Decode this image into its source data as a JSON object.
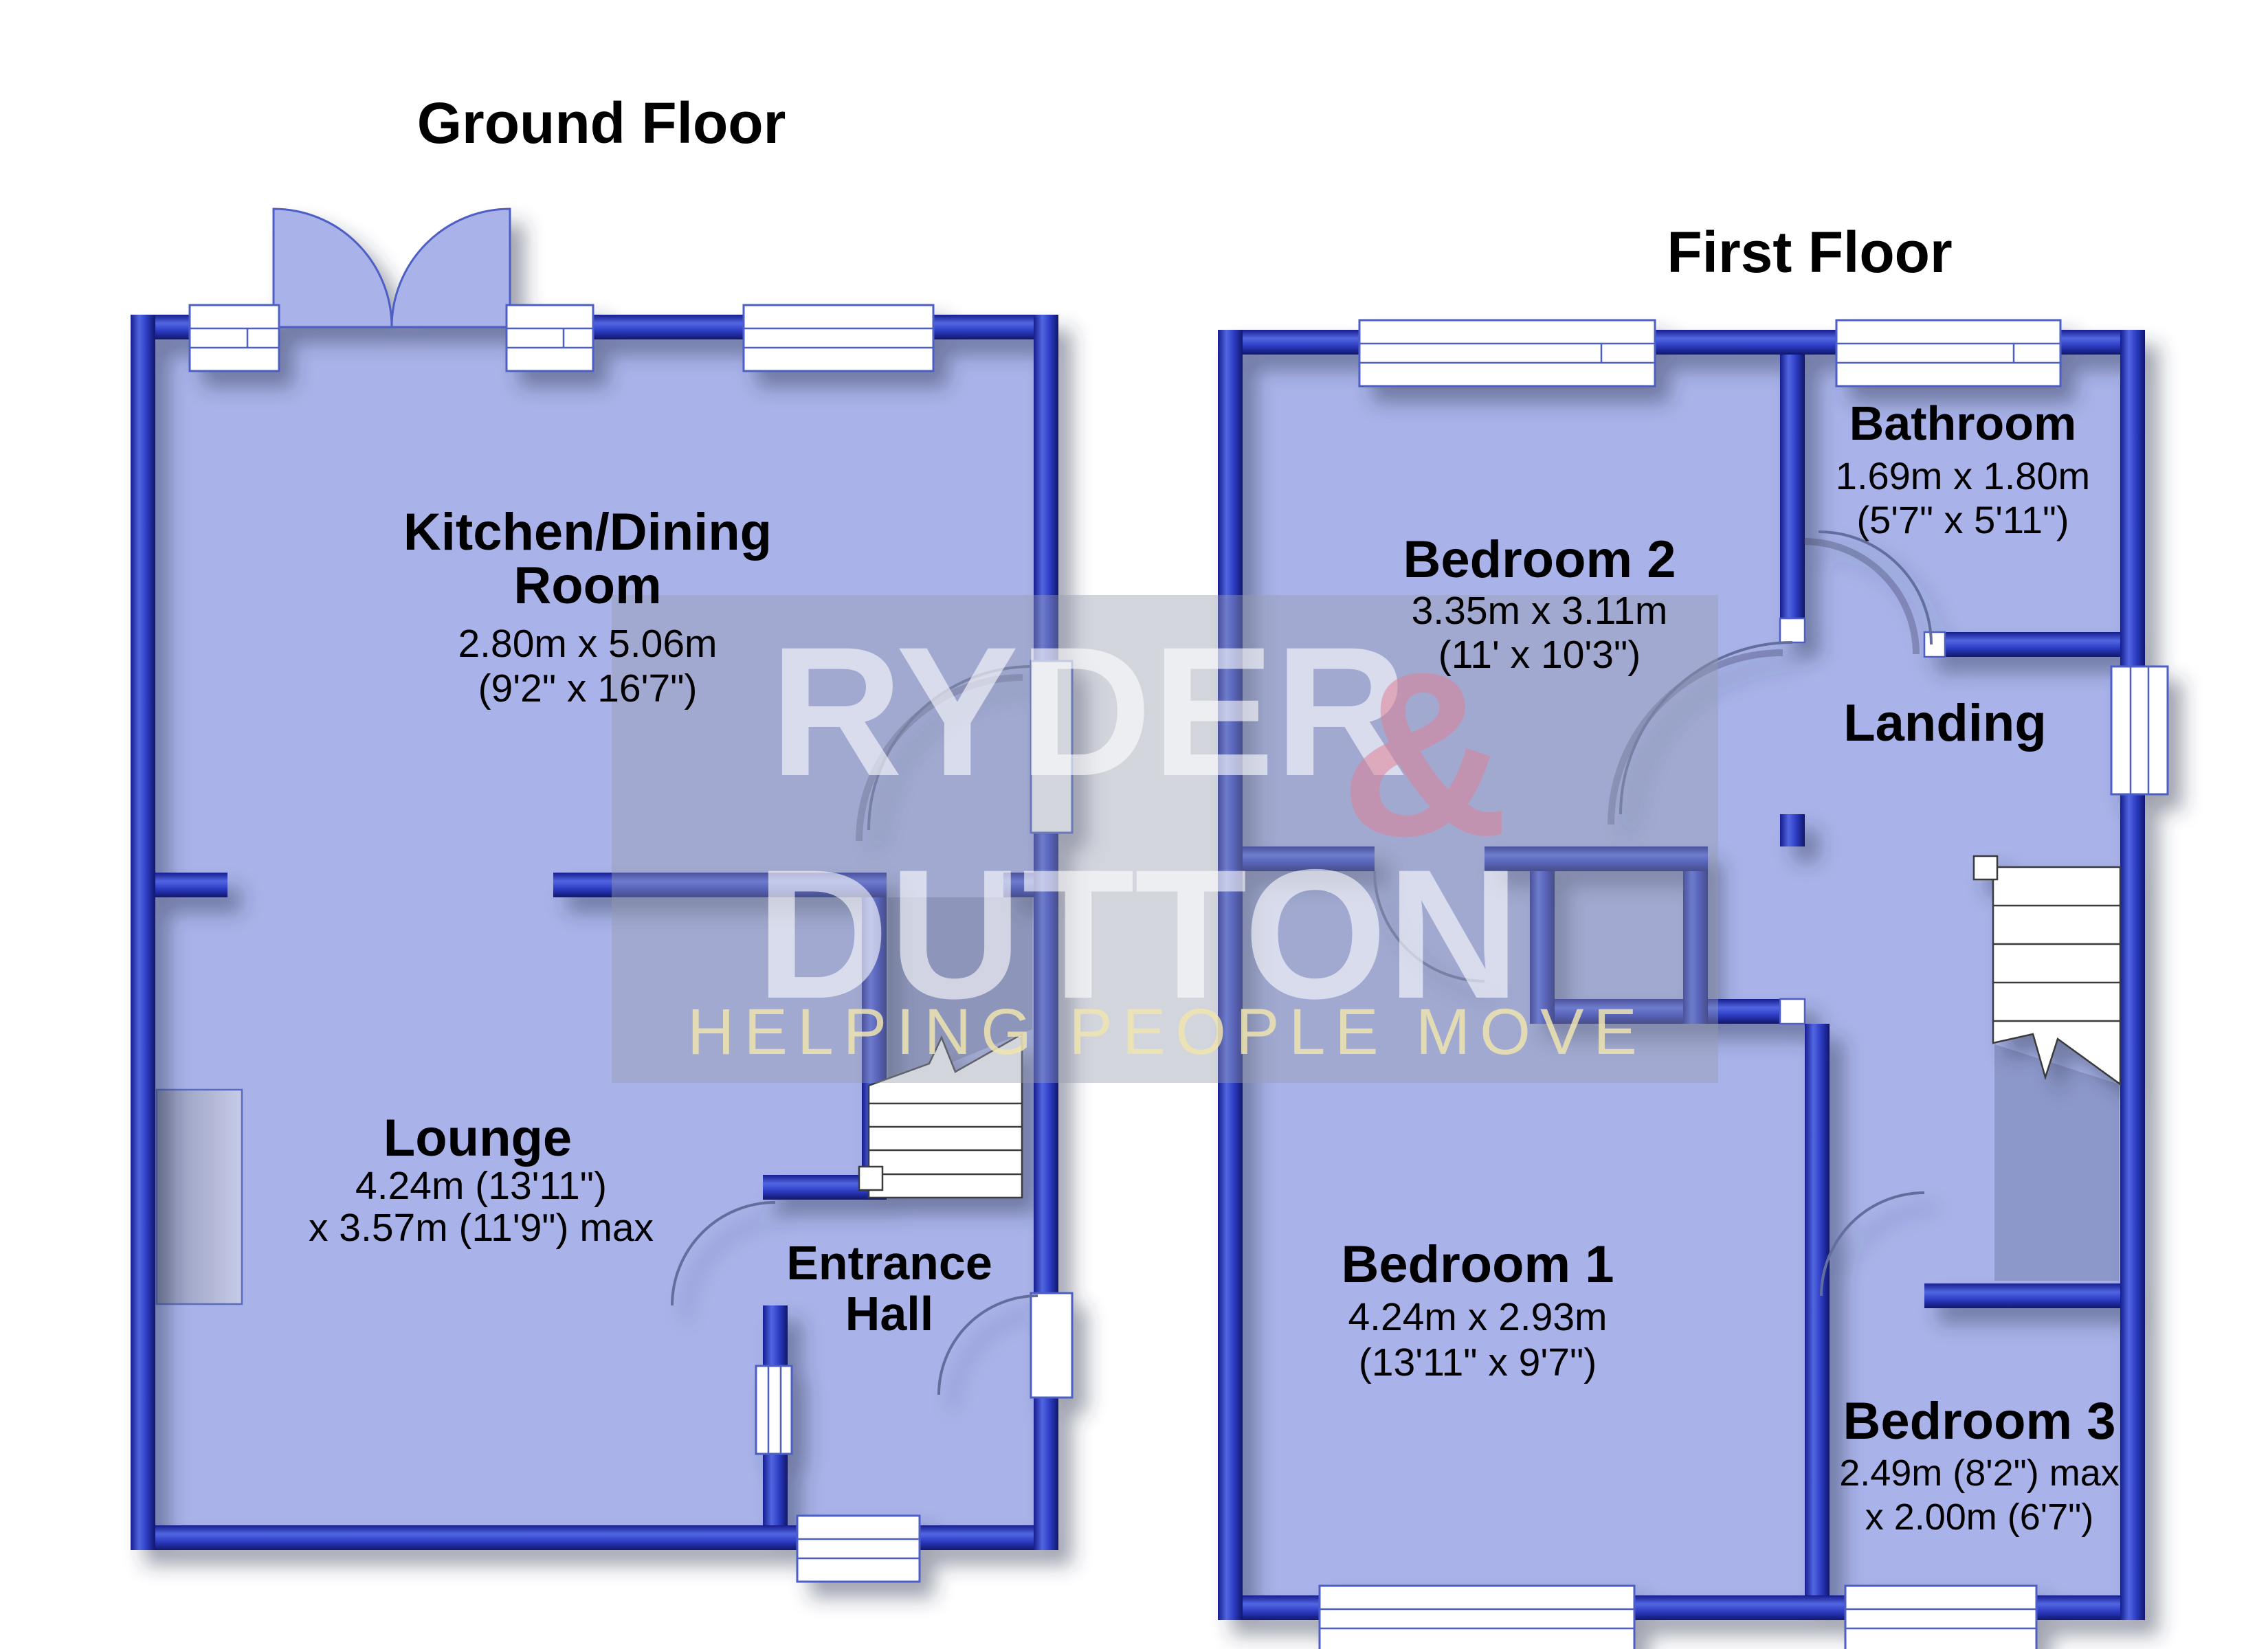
{
  "document": {
    "type": "floorplan",
    "background": "#ffffff"
  },
  "colors": {
    "wall_blue": "#3142c8",
    "wall_dark": "#141c86",
    "floor_fill": "#a9b3e9",
    "window_outline": "#4e5ec4",
    "label_text": "#000000",
    "watermark_box": "rgba(150,155,175,0.42)",
    "watermark_text": "rgba(255,255,255,0.60)",
    "watermark_amp": "rgba(222,130,150,0.55)",
    "watermark_tagline": "rgba(238,228,175,0.85)"
  },
  "watermark": {
    "name_line1": "RYDER",
    "amp": "&",
    "name_line2": "DUTTON",
    "tagline": "HELPING PEOPLE MOVE"
  },
  "ground": {
    "title": "Ground Floor",
    "kitchen": {
      "name_line1": "Kitchen/Dining",
      "name_line2": "Room",
      "dims_line1": "2.80m x 5.06m",
      "dims_line2": "(9'2\" x 16'7\")"
    },
    "lounge": {
      "name_line1": "Lounge",
      "dims_line1": "4.24m (13'11\")",
      "dims_line2": "x 3.57m (11'9\") max"
    },
    "hall": {
      "name_line1": "Entrance",
      "name_line2": "Hall"
    }
  },
  "first": {
    "title": "First Floor",
    "bedroom2": {
      "name_line1": "Bedroom 2",
      "dims_line1": "3.35m x 3.11m",
      "dims_line2": "(11' x 10'3\")"
    },
    "bathroom": {
      "name_line1": "Bathroom",
      "dims_line1": "1.69m x 1.80m",
      "dims_line2": "(5'7\" x 5'11\")"
    },
    "landing": {
      "name_line1": "Landing"
    },
    "bedroom1": {
      "name_line1": "Bedroom 1",
      "dims_line1": "4.24m x 2.93m",
      "dims_line2": "(13'11\" x 9'7\")"
    },
    "bedroom3": {
      "name_line1": "Bedroom 3",
      "dims_line1": "2.49m (8'2\") max",
      "dims_line2": "x 2.00m (6'7\")"
    }
  }
}
